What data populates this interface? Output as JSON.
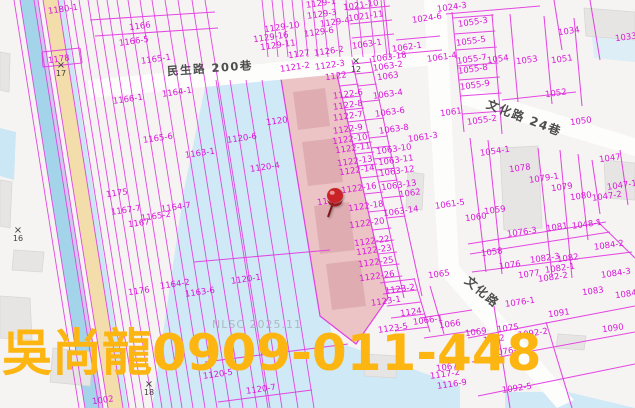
{
  "map": {
    "watermark": "NLSC 2025.11",
    "overlay_text": "吳尚龍0909-011-448",
    "highlighted_parcel": "1121",
    "colors": {
      "parcel_line": "#e23ee2",
      "parcel_label": "#d916d9",
      "highlight_fill": "#ecc4c6",
      "water_fill": "#cfe9f6",
      "overlay_text": "#fdb511",
      "road_label": "#4d4d4d",
      "pin_red": "#c92327"
    },
    "roads": [
      {
        "name": "民生路 200巷",
        "x": 210,
        "y": 69,
        "rotate": -4,
        "size": 11.5
      },
      {
        "name": "文化路 24巷",
        "x": 524,
        "y": 118,
        "rotate": 21,
        "size": 12
      },
      {
        "name": "文化路",
        "x": 482,
        "y": 292,
        "rotate": 40,
        "size": 12
      }
    ],
    "markers": [
      {
        "label": "17",
        "x": 61,
        "y": 70
      },
      {
        "label": "12",
        "x": 356,
        "y": 66
      },
      {
        "label": "16",
        "x": 18,
        "y": 235
      },
      {
        "label": "18",
        "x": 149,
        "y": 389
      }
    ],
    "parcels": [
      {
        "t": "1180-1",
        "x": 63,
        "y": 10
      },
      {
        "t": "1166",
        "x": 140,
        "y": 27
      },
      {
        "t": "1166-5",
        "x": 134,
        "y": 42
      },
      {
        "t": "1178",
        "x": 59,
        "y": 60
      },
      {
        "t": "1165-1",
        "x": 156,
        "y": 60
      },
      {
        "t": "1164-1",
        "x": 177,
        "y": 93
      },
      {
        "t": "1166-1",
        "x": 128,
        "y": 100
      },
      {
        "t": "1165-6",
        "x": 158,
        "y": 139
      },
      {
        "t": "1163-1",
        "x": 200,
        "y": 154
      },
      {
        "t": "1175",
        "x": 117,
        "y": 194
      },
      {
        "t": "1167-7",
        "x": 126,
        "y": 211
      },
      {
        "t": "1164-7",
        "x": 176,
        "y": 208
      },
      {
        "t": "1165-2",
        "x": 156,
        "y": 217
      },
      {
        "t": "1167",
        "x": 139,
        "y": 224
      },
      {
        "t": "1164-2",
        "x": 175,
        "y": 285
      },
      {
        "t": "1176",
        "x": 139,
        "y": 292
      },
      {
        "t": "1163-6",
        "x": 200,
        "y": 293
      },
      {
        "t": "1002",
        "x": 103,
        "y": 401
      },
      {
        "t": "1129-1",
        "x": 321,
        "y": 4
      },
      {
        "t": "1021-10",
        "x": 361,
        "y": 6
      },
      {
        "t": "1129-3",
        "x": 322,
        "y": 15
      },
      {
        "t": "1021-11",
        "x": 366,
        "y": 17
      },
      {
        "t": "1129-4",
        "x": 335,
        "y": 23
      },
      {
        "t": "1129-10",
        "x": 282,
        "y": 28
      },
      {
        "t": "1129-6",
        "x": 319,
        "y": 33
      },
      {
        "t": "1129-16",
        "x": 271,
        "y": 38
      },
      {
        "t": "1129-11",
        "x": 278,
        "y": 46
      },
      {
        "t": "1127",
        "x": 299,
        "y": 55
      },
      {
        "t": "1126-2",
        "x": 329,
        "y": 52
      },
      {
        "t": "1121-2",
        "x": 295,
        "y": 68
      },
      {
        "t": "1122-3",
        "x": 330,
        "y": 66
      },
      {
        "t": "1122",
        "x": 336,
        "y": 77
      },
      {
        "t": "1122-6",
        "x": 348,
        "y": 95
      },
      {
        "t": "1122-8",
        "x": 348,
        "y": 106
      },
      {
        "t": "1122-7",
        "x": 348,
        "y": 117
      },
      {
        "t": "1122-9",
        "x": 348,
        "y": 130
      },
      {
        "t": "1122-10",
        "x": 350,
        "y": 140
      },
      {
        "t": "1122-11",
        "x": 353,
        "y": 149
      },
      {
        "t": "1122-13",
        "x": 355,
        "y": 162
      },
      {
        "t": "1122-14",
        "x": 357,
        "y": 171
      },
      {
        "t": "1122-16",
        "x": 359,
        "y": 189
      },
      {
        "t": "1121",
        "x": 328,
        "y": 202
      },
      {
        "t": "1122-18",
        "x": 366,
        "y": 207
      },
      {
        "t": "1122-20",
        "x": 367,
        "y": 224
      },
      {
        "t": "1122-22",
        "x": 372,
        "y": 242
      },
      {
        "t": "1122-23",
        "x": 374,
        "y": 251
      },
      {
        "t": "1122-25",
        "x": 376,
        "y": 263
      },
      {
        "t": "1122-26",
        "x": 377,
        "y": 277
      },
      {
        "t": "1063-1",
        "x": 367,
        "y": 45
      },
      {
        "t": "1063-18",
        "x": 389,
        "y": 58
      },
      {
        "t": "1062-1",
        "x": 407,
        "y": 48
      },
      {
        "t": "1063-2",
        "x": 388,
        "y": 67
      },
      {
        "t": "1063",
        "x": 388,
        "y": 77
      },
      {
        "t": "1063-4",
        "x": 388,
        "y": 95
      },
      {
        "t": "1063-6",
        "x": 390,
        "y": 113
      },
      {
        "t": "1063-8",
        "x": 394,
        "y": 130
      },
      {
        "t": "1061-3",
        "x": 423,
        "y": 138
      },
      {
        "t": "1063-10",
        "x": 394,
        "y": 150
      },
      {
        "t": "1063-11",
        "x": 396,
        "y": 161
      },
      {
        "t": "1063-12",
        "x": 397,
        "y": 172
      },
      {
        "t": "1063-13",
        "x": 399,
        "y": 186
      },
      {
        "t": "1062",
        "x": 410,
        "y": 194
      },
      {
        "t": "1063-14",
        "x": 401,
        "y": 212
      },
      {
        "t": "1120",
        "x": 277,
        "y": 122
      },
      {
        "t": "1120-6",
        "x": 242,
        "y": 139
      },
      {
        "t": "1120-4",
        "x": 265,
        "y": 168
      },
      {
        "t": "1120-1",
        "x": 246,
        "y": 280
      },
      {
        "t": "1120-5",
        "x": 218,
        "y": 375
      },
      {
        "t": "1120-7",
        "x": 261,
        "y": 390
      },
      {
        "t": "1123-2",
        "x": 400,
        "y": 290
      },
      {
        "t": "1123-1",
        "x": 386,
        "y": 302
      },
      {
        "t": "1124",
        "x": 411,
        "y": 313
      },
      {
        "t": "1123-5",
        "x": 393,
        "y": 329
      },
      {
        "t": "1066-1",
        "x": 428,
        "y": 321
      },
      {
        "t": "1066",
        "x": 450,
        "y": 325
      },
      {
        "t": "1065",
        "x": 439,
        "y": 275
      },
      {
        "t": "1024-3",
        "x": 452,
        "y": 8
      },
      {
        "t": "1024-6",
        "x": 427,
        "y": 19
      },
      {
        "t": "1055-3",
        "x": 473,
        "y": 23
      },
      {
        "t": "1055-5",
        "x": 471,
        "y": 42
      },
      {
        "t": "1061-4",
        "x": 442,
        "y": 58
      },
      {
        "t": "1055-7",
        "x": 472,
        "y": 60
      },
      {
        "t": "1054",
        "x": 498,
        "y": 60
      },
      {
        "t": "1053",
        "x": 527,
        "y": 61
      },
      {
        "t": "1051",
        "x": 562,
        "y": 60
      },
      {
        "t": "1034",
        "x": 569,
        "y": 32
      },
      {
        "t": "1033",
        "x": 626,
        "y": 38
      },
      {
        "t": "1055-8",
        "x": 473,
        "y": 70
      },
      {
        "t": "1055-9",
        "x": 475,
        "y": 86
      },
      {
        "t": "1052",
        "x": 556,
        "y": 94
      },
      {
        "t": "1061",
        "x": 451,
        "y": 113
      },
      {
        "t": "1055-2",
        "x": 482,
        "y": 121
      },
      {
        "t": "1050",
        "x": 581,
        "y": 122
      },
      {
        "t": "1054-1",
        "x": 495,
        "y": 152
      },
      {
        "t": "1078",
        "x": 520,
        "y": 169
      },
      {
        "t": "1079-1",
        "x": 544,
        "y": 179
      },
      {
        "t": "1079",
        "x": 562,
        "y": 188
      },
      {
        "t": "1047",
        "x": 610,
        "y": 159
      },
      {
        "t": "1047-1",
        "x": 622,
        "y": 186
      },
      {
        "t": "1080",
        "x": 581,
        "y": 197
      },
      {
        "t": "1047-2",
        "x": 607,
        "y": 197
      },
      {
        "t": "1061-5",
        "x": 450,
        "y": 205
      },
      {
        "t": "1059",
        "x": 495,
        "y": 211
      },
      {
        "t": "1060",
        "x": 476,
        "y": 218
      },
      {
        "t": "1076-3",
        "x": 522,
        "y": 233
      },
      {
        "t": "1081",
        "x": 557,
        "y": 228
      },
      {
        "t": "1048-1",
        "x": 587,
        "y": 225
      },
      {
        "t": "1084-2",
        "x": 609,
        "y": 246
      },
      {
        "t": "1058",
        "x": 492,
        "y": 253
      },
      {
        "t": "1082-3",
        "x": 545,
        "y": 259
      },
      {
        "t": "1082",
        "x": 568,
        "y": 259
      },
      {
        "t": "1076",
        "x": 510,
        "y": 266
      },
      {
        "t": "1082-1",
        "x": 560,
        "y": 269
      },
      {
        "t": "1077",
        "x": 529,
        "y": 275
      },
      {
        "t": "1082-2",
        "x": 553,
        "y": 278
      },
      {
        "t": "1084-3",
        "x": 616,
        "y": 274
      },
      {
        "t": "1083",
        "x": 593,
        "y": 292
      },
      {
        "t": "1084",
        "x": 626,
        "y": 295
      },
      {
        "t": "1076-1",
        "x": 520,
        "y": 303
      },
      {
        "t": "1091",
        "x": 559,
        "y": 314
      },
      {
        "t": "1090",
        "x": 613,
        "y": 329
      },
      {
        "t": "1069",
        "x": 476,
        "y": 333
      },
      {
        "t": "1072",
        "x": 494,
        "y": 340
      },
      {
        "t": "1075",
        "x": 508,
        "y": 329
      },
      {
        "t": "1092-2",
        "x": 533,
        "y": 334
      },
      {
        "t": "1076-2",
        "x": 507,
        "y": 352
      },
      {
        "t": "1067",
        "x": 447,
        "y": 368
      },
      {
        "t": "1117-2",
        "x": 445,
        "y": 375
      },
      {
        "t": "1116-9",
        "x": 452,
        "y": 385
      },
      {
        "t": "1092-5",
        "x": 517,
        "y": 389
      }
    ]
  }
}
